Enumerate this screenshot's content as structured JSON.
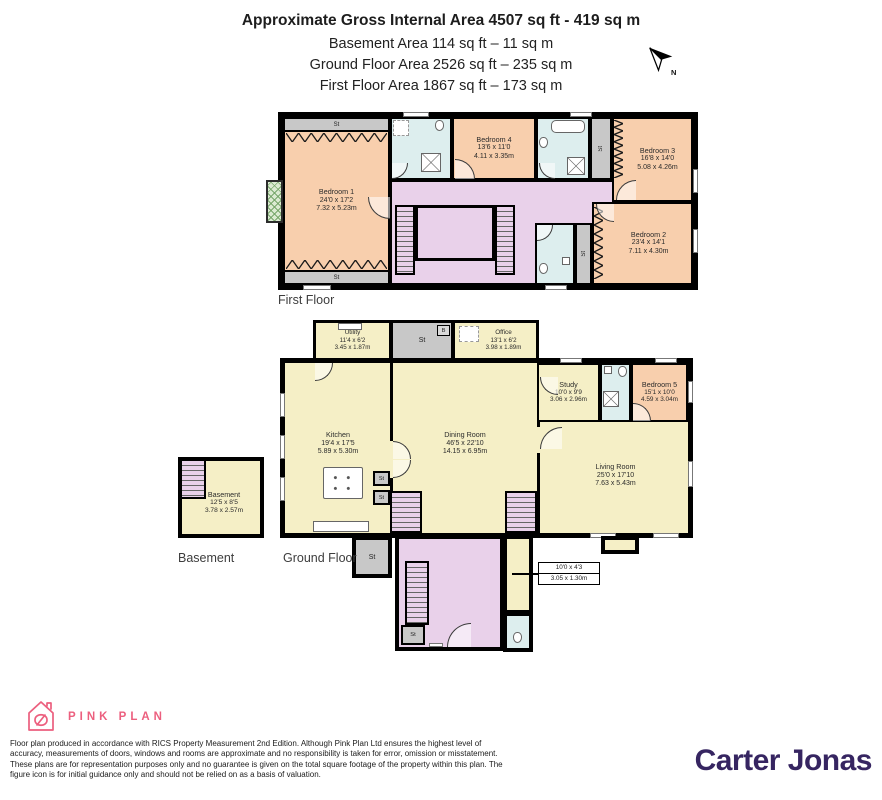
{
  "header": {
    "title": "Approximate Gross Internal Area 4507 sq ft - 419 sq m",
    "basement_area": "Basement Area 114 sq ft – 11 sq m",
    "ground_area": "Ground Floor Area 2526 sq ft – 235 sq m",
    "first_area": "First Floor Area 1867 sq ft – 173 sq m"
  },
  "compass": {
    "label": "N"
  },
  "floors": {
    "first": "First Floor",
    "ground": "Ground Floor",
    "basement": "Basement"
  },
  "rooms": {
    "bedroom1": {
      "name": "Bedroom 1",
      "ft": "24'0 x 17'2",
      "m": "7.32 x 5.23m"
    },
    "bedroom2": {
      "name": "Bedroom 2",
      "ft": "23'4 x 14'1",
      "m": "7.11 x 4.30m"
    },
    "bedroom3": {
      "name": "Bedroom 3",
      "ft": "16'8 x 14'0",
      "m": "5.08 x 4.26m"
    },
    "bedroom4": {
      "name": "Bedroom 4",
      "ft": "13'6 x 11'0",
      "m": "4.11 x 3.35m"
    },
    "bedroom5": {
      "name": "Bedroom 5",
      "ft": "15'1 x 10'0",
      "m": "4.59 x 3.04m"
    },
    "kitchen": {
      "name": "Kitchen",
      "ft": "19'4 x 17'5",
      "m": "5.89 x 5.30m"
    },
    "dining": {
      "name": "Dining Room",
      "ft": "46'5 x 22'10",
      "m": "14.15 x 6.95m"
    },
    "living": {
      "name": "Living Room",
      "ft": "25'0 x 17'10",
      "m": "7.63 x 5.43m"
    },
    "study": {
      "name": "Study",
      "ft": "10'0 x 9'9",
      "m": "3.06 x 2.96m"
    },
    "office": {
      "name": "Office",
      "ft": "13'1 x 6'2",
      "m": "3.98 x 1.89m"
    },
    "utility": {
      "name": "Utility",
      "ft": "11'4 x 6'2",
      "m": "3.45 x 1.87m"
    },
    "basement": {
      "name": "Basement",
      "ft": "12'5 x 8'5",
      "m": "3.78 x 2.57m"
    },
    "hall_callout": {
      "ft": "10'0 x 4'3",
      "m": "3.05 x 1.30m"
    }
  },
  "markers": {
    "st": "St",
    "b": "B"
  },
  "footer": {
    "brand": "PINK PLAN",
    "disclaimer": "Floor plan produced in accordance with RICS Property Measurement 2nd Edition. Although Pink Plan Ltd ensures the highest level of accuracy, measurements of doors, windows and rooms are approximate and no responsibility is taken for error, omission or misstatement. These plans are for representation purposes only and no guarantee is given on the total square footage of the property within this plan. The figure icon is for initial guidance only and should not be relied on as a basis of valuation.",
    "agent": "Carter Jonas"
  },
  "colors": {
    "bedroom_fill": "#f8cfad",
    "living_fill": "#f5efc6",
    "hall_fill": "#e9d1ea",
    "bath_fill": "#ddeeee",
    "storage_fill": "#c8c8c8",
    "wall": "#000000",
    "brand_pink": "#ec5f7e",
    "agent_purple": "#362561"
  }
}
